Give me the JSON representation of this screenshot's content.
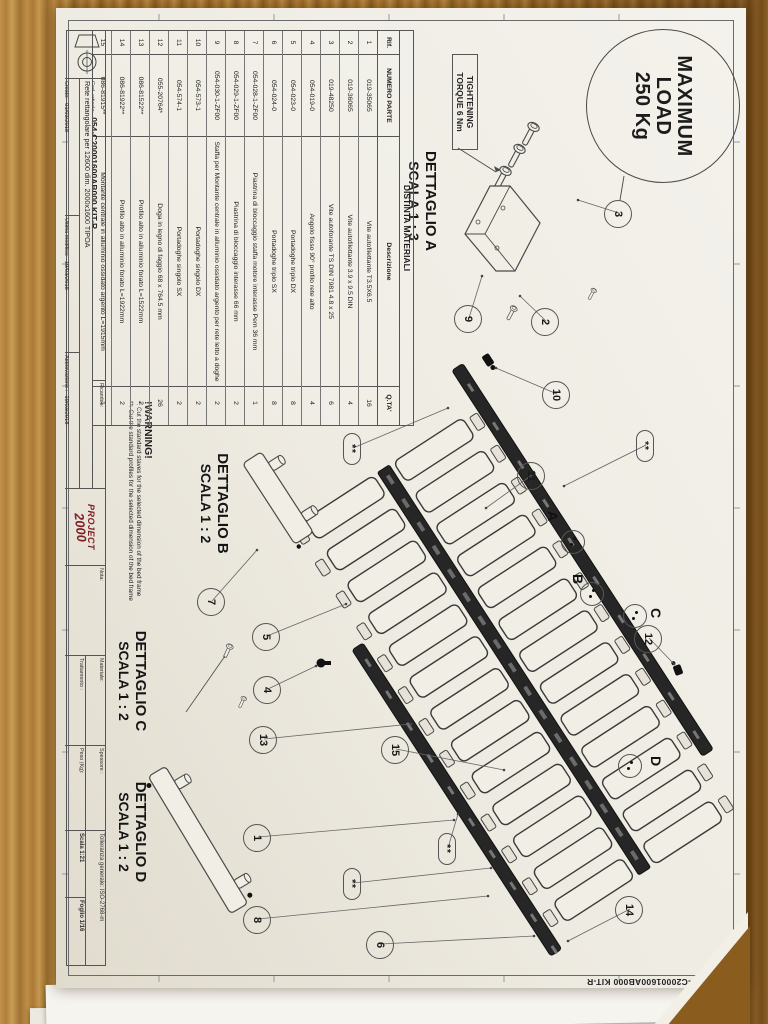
{
  "load_badge": {
    "l1": "MAXIMUM",
    "l2": "LOAD",
    "l3": "250 Kg"
  },
  "torque": {
    "l1": "TIGHTENING",
    "l2": "TORQUE 6 Nm"
  },
  "details": {
    "a": {
      "title": "DETTAGLIO A",
      "scale": "SCALA 1 : 3"
    },
    "b": {
      "title": "DETTAGLIO B",
      "scale": "SCALA 1 : 2"
    },
    "c": {
      "title": "DETTAGLIO C",
      "scale": "SCALA 1 : 2"
    },
    "d": {
      "title": "DETTAGLIO D",
      "scale": "SCALA 1 : 2"
    }
  },
  "warning": {
    "title": "!WARNING!",
    "l1": "*: Cut the standard staves for the selected dimension of the bed frame",
    "l2": "**: Cut the standard profiles for the selected dimension of the bed frame"
  },
  "bom": {
    "title": "DISTINTA MATERIALI",
    "headers": [
      "Rif.",
      "NUMERO PARTE",
      "Descrizione",
      "Q.TA'"
    ],
    "rows": [
      [
        "1",
        "019-35065",
        "Vite autofilettante T3.5X6.5",
        "16"
      ],
      [
        "2",
        "019-36065",
        "Vite autofilettante 3.9 x 9.5 DIN",
        "4"
      ],
      [
        "3",
        "019-48250",
        "Vite autoforante TS DIN 7981 4.8 x 25",
        "6"
      ],
      [
        "4",
        "054-019-0",
        "Angolo fisso 90° profilo rete alto",
        "4"
      ],
      [
        "5",
        "054-023-0",
        "Portadoghe triplo DX",
        "8"
      ],
      [
        "6",
        "054-024-0",
        "Portadoghe triplo SX",
        "8"
      ],
      [
        "7",
        "054-028-1-ZF00",
        "Piastrina di bloccaggio staffa motore interasse Pem 36 mm",
        "1"
      ],
      [
        "8",
        "054-029-1-ZF00",
        "Piastrina di bloccaggio interasse 66 mm",
        "2"
      ],
      [
        "9",
        "054-030-1-ZF00",
        "Staffa per Montante centrale in alluminio ossidato argento per rete letto a doghe",
        "2"
      ],
      [
        "10",
        "054-573-1",
        "Portadoghe singolo DX",
        "2"
      ],
      [
        "11",
        "054-574-1",
        "Portadoghe singolo SX",
        "2"
      ],
      [
        "12",
        "055-20764*",
        "Doga in legno di faggio 68 x 764.5 mm",
        "26"
      ],
      [
        "13",
        "086-81522**",
        "Profilo alto in alluminio forato L=1522mm",
        "2"
      ],
      [
        "14",
        "086-81922**",
        "Profilo alto in alluminio forato L=1922mm",
        "2"
      ],
      [
        "15",
        "086-81915**",
        "Montante centrale in alluminio ossidato argento L=1915mm",
        "1"
      ]
    ]
  },
  "title_block": {
    "cod_label": "Cod. articolo:",
    "cod_value": "054-C20001600AB000 KIT-R",
    "ricambio_label": "Ricambio:",
    "description": "Rete rettangolare per 12600 dim. 2000x1600 TIPOA",
    "creato_label": "Creato:",
    "creato_date": "01/03/2018",
    "creato_by": "ADMIN",
    "modifica_label": "Ultima modifica:",
    "modifica_date": "19/03/2018",
    "modifica_by": "ADMIN",
    "approva_label": "Approvazione :",
    "approva_date": "19/03/2018",
    "approva_by": "F. Romagnoli",
    "logo_line1": "PROJECT",
    "logo_line2": "2000",
    "nota_label": "Nota:",
    "materiale_label": "Materiale:",
    "trattamento_label": "Trattamento :",
    "spessore_label": "Spessore :",
    "peso_label": "Peso (Kg):",
    "tolleranza": "Tolleranza generale: ISO-2768-m",
    "scala": "Scala  1:21",
    "foglio": "Foglio  1/16",
    "logo_color": "#7d1f24"
  },
  "corner_code": "054-C20001600AB000 KIT-R",
  "callouts": [
    {
      "t": "3",
      "x": 205,
      "y": 127,
      "tx": 192,
      "ty": 168
    },
    {
      "t": "2",
      "x": 313,
      "y": 200,
      "tx": 288,
      "ty": 226
    },
    {
      "t": "9",
      "x": 310,
      "y": 277,
      "tx": 268,
      "ty": 264
    },
    {
      "t": "10",
      "x": 386,
      "y": 189,
      "tx": 360,
      "ty": 250
    },
    {
      "t": "11",
      "x": 467,
      "y": 214,
      "tx": 500,
      "ty": 260
    },
    {
      "t": "12",
      "x": 630,
      "y": 97,
      "tx": 656,
      "ty": 72
    },
    {
      "t": "14",
      "x": 901,
      "y": 116,
      "tx": 933,
      "ty": 178
    },
    {
      "t": "15",
      "x": 741,
      "y": 350,
      "tx": 762,
      "ty": 242
    },
    {
      "t": "13",
      "x": 731,
      "y": 482,
      "tx": 716,
      "ty": 335
    },
    {
      "t": "5",
      "x": 628,
      "y": 479,
      "tx": 596,
      "ty": 400
    },
    {
      "t": "4",
      "x": 681,
      "y": 478,
      "tx": 658,
      "ty": 430
    },
    {
      "t": "7",
      "x": 593,
      "y": 534,
      "tx": 542,
      "ty": 489
    },
    {
      "t": "1",
      "x": 829,
      "y": 488,
      "tx": 812,
      "ty": 292
    },
    {
      "t": "8",
      "x": 911,
      "y": 488,
      "tx": 888,
      "ty": 258
    },
    {
      "t": "6",
      "x": 936,
      "y": 365,
      "tx": 928,
      "ty": 212
    },
    {
      "t": "**",
      "star": true,
      "x": 437,
      "y": 100,
      "tx": 478,
      "ty": 182
    },
    {
      "t": "**",
      "star": true,
      "x": 440,
      "y": 393,
      "tx": 400,
      "ty": 298
    },
    {
      "t": "**",
      "star": true,
      "x": 840,
      "y": 298,
      "tx": 806,
      "ty": 288
    },
    {
      "t": "**",
      "star": true,
      "x": 875,
      "y": 393,
      "tx": 860,
      "ty": 255
    }
  ],
  "detail_letters": [
    {
      "t": "A",
      "x": 503,
      "y": 185,
      "cx": 533,
      "cy": 172
    },
    {
      "t": "B",
      "x": 566,
      "y": 160,
      "cx": 585,
      "cy": 153
    },
    {
      "t": "C",
      "x": 600,
      "y": 82,
      "cx": 607,
      "cy": 110
    },
    {
      "t": "D",
      "x": 748,
      "y": 82,
      "cx": 757,
      "cy": 115
    }
  ]
}
